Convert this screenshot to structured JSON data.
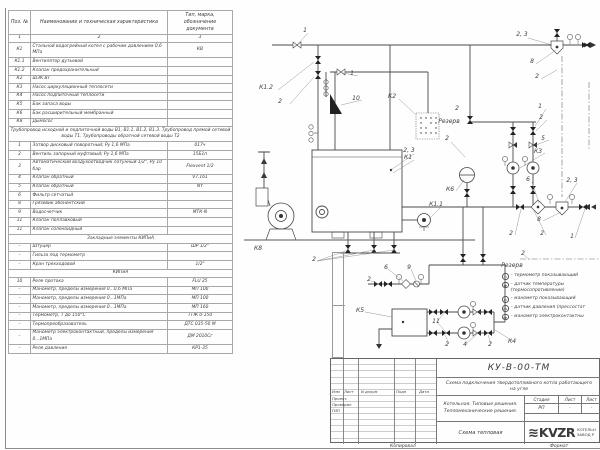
{
  "table": {
    "headers": {
      "pos": "Поз. №",
      "name": "Наименование и техническая характеристика",
      "type": "Тип, марка, обозначение документа"
    },
    "column_numbers": [
      "1",
      "2",
      "3"
    ],
    "rows": [
      {
        "p": "К1",
        "n": "Стальной водогрейный котел с рабочим давлением 0,6 МПа",
        "t": "КВ"
      },
      {
        "p": "К1.1",
        "n": "Вентилятор дутьевой",
        "t": ""
      },
      {
        "p": "К1.2",
        "n": "Клапан предохранительный",
        "t": ""
      },
      {
        "p": "К2",
        "n": "ШЗК ВТ",
        "t": ""
      },
      {
        "p": "К3",
        "n": "Насос циркуляционный теплосети",
        "t": ""
      },
      {
        "p": "К4",
        "n": "Насос подпиточный теплосети",
        "t": ""
      },
      {
        "p": "К5",
        "n": "Бак запаса воды",
        "t": ""
      },
      {
        "p": "К6",
        "n": "Бак расширительный мембранный",
        "t": ""
      },
      {
        "p": "К8",
        "n": "Дымосос",
        "t": ""
      },
      {
        "s": "Трубопровод исходной и подпиточной воды В1, В1.1, В1.2, В1.3. Трубопровод прямой сетевой воды Т1. Трубопроводы обратной сетевой воды Т2"
      },
      {
        "p": "1",
        "n": "Затвор дисковый поворотный; Ру 1,6 МПа",
        "t": "017ч"
      },
      {
        "p": "2",
        "n": "Вентиль запорный муфтовый; Ру 1,6 МПа",
        "t": "15Б1п"
      },
      {
        "p": "3",
        "n": "Автоматический воздухоотводчик латунный 1/2\", Ру 10 бар",
        "t": "Flexvent 1/2"
      },
      {
        "p": "4",
        "n": "Клапан обратный",
        "t": "V7.161"
      },
      {
        "p": "5",
        "n": "Клапан обратный",
        "t": "NY"
      },
      {
        "p": "6",
        "n": "Фильтр сетчатый",
        "t": ""
      },
      {
        "p": "8",
        "n": "Грязевик абонентский",
        "t": ""
      },
      {
        "p": "9",
        "n": "Водосчетчик",
        "t": "МТК-N"
      },
      {
        "p": "11",
        "n": "Клапан поплавковый",
        "t": ""
      },
      {
        "p": "11",
        "n": "Клапан соленоидный",
        "t": ""
      },
      {
        "s": "Закладные элементы КИПиА"
      },
      {
        "p": "–",
        "n": "Штуцер",
        "t": "ШР 1/2\""
      },
      {
        "p": "–",
        "n": "Гильза под термометр",
        "t": ""
      },
      {
        "p": "–",
        "n": "Кран трехходовой",
        "t": "1/2\""
      },
      {
        "s": "КИПиА"
      },
      {
        "p": "10",
        "n": "Реле протока",
        "t": "FLU 25"
      },
      {
        "p": "–",
        "n": "Манометр, пределы измерения 0...0,6 МПа",
        "t": "МП 100"
      },
      {
        "p": "–",
        "n": "Манометр, пределы измерения 0...1МПа",
        "t": "МП 100"
      },
      {
        "p": "–",
        "n": "Манометр, пределы измерения 0...1МПа",
        "t": "МП 160"
      },
      {
        "p": "–",
        "n": "Термометр, Т до 150°С",
        "t": "ТТЖ 0-150"
      },
      {
        "p": "–",
        "n": "Термопреобразователь",
        "t": "ДТС 035-50 М"
      },
      {
        "p": "–",
        "n": "Манометр электроконтактный, пределы измерения 0...1МПа",
        "t": "ДМ 2010Сг"
      },
      {
        "p": "–",
        "n": "Реле давления",
        "t": "КР1-35"
      }
    ]
  },
  "schematic": {
    "labels": [
      {
        "t": "1",
        "x": 305,
        "y": 31
      },
      {
        "t": "К1.2",
        "x": 266,
        "y": 88
      },
      {
        "t": "2",
        "x": 280,
        "y": 102
      },
      {
        "t": "1",
        "x": 352,
        "y": 74
      },
      {
        "t": "10",
        "x": 356,
        "y": 99
      },
      {
        "t": "К2",
        "x": 392,
        "y": 97
      },
      {
        "t": "Резерв",
        "x": 449,
        "y": 122
      },
      {
        "t": "2",
        "x": 457,
        "y": 109
      },
      {
        "t": "2, 3",
        "x": 409,
        "y": 151
      },
      {
        "t": "К1",
        "x": 408,
        "y": 158
      },
      {
        "t": "К8",
        "x": 258,
        "y": 249
      },
      {
        "t": "К1.1",
        "x": 436,
        "y": 205
      },
      {
        "t": "К6",
        "x": 450,
        "y": 190
      },
      {
        "t": "2",
        "x": 447,
        "y": 139
      },
      {
        "t": "2, 3",
        "x": 522,
        "y": 35
      },
      {
        "t": "8",
        "x": 532,
        "y": 62
      },
      {
        "t": "2",
        "x": 537,
        "y": 77
      },
      {
        "t": "1",
        "x": 540,
        "y": 107
      },
      {
        "t": "2",
        "x": 541,
        "y": 118
      },
      {
        "t": "5",
        "x": 543,
        "y": 139
      },
      {
        "t": "К3",
        "x": 538,
        "y": 152
      },
      {
        "t": "6",
        "x": 528,
        "y": 180
      },
      {
        "t": "2, 3",
        "x": 572,
        "y": 181
      },
      {
        "t": "8",
        "x": 539,
        "y": 220
      },
      {
        "t": "2",
        "x": 511,
        "y": 234
      },
      {
        "t": "2",
        "x": 542,
        "y": 234
      },
      {
        "t": "1",
        "x": 572,
        "y": 237
      },
      {
        "t": "2",
        "x": 314,
        "y": 260
      },
      {
        "t": "2",
        "x": 369,
        "y": 280
      },
      {
        "t": "6",
        "x": 386,
        "y": 268
      },
      {
        "t": "9",
        "x": 409,
        "y": 268
      },
      {
        "t": "2",
        "x": 523,
        "y": 254
      },
      {
        "t": "К5",
        "x": 360,
        "y": 311
      },
      {
        "t": "11",
        "x": 436,
        "y": 322
      },
      {
        "t": "2",
        "x": 447,
        "y": 345
      },
      {
        "t": "4",
        "x": 465,
        "y": 345
      },
      {
        "t": "2",
        "x": 490,
        "y": 345
      },
      {
        "t": "К4",
        "x": 512,
        "y": 342
      },
      {
        "t": "Резерв",
        "x": 512,
        "y": 266
      }
    ],
    "legend": {
      "items": [
        {
          "sym": "TI",
          "text": "– термометр показывающий"
        },
        {
          "sym": "TE",
          "text": "– датчик температуры\n(термосопротивление)"
        },
        {
          "sym": "PI",
          "text": "– манометр показывающий"
        },
        {
          "sym": "PS",
          "text": "– датчик давления (прессостат"
        },
        {
          "sym": "PE",
          "text": "– манометр электроконтактны"
        }
      ]
    }
  },
  "title_block": {
    "doc_number": "КУ-В-00-ТМ",
    "subject": "Схема подключения твердотопливного котла работающего на угле",
    "object_line1": "Котельная. Типовые решения.",
    "object_line2": "Тепломеханические решения.",
    "sheet_name": "Схема тепловая",
    "stage_label": "Стадия",
    "sheet_label": "Лист",
    "sheets_label": "Лист",
    "stage": "РП",
    "sheet": "-",
    "sheets": "-",
    "sig_cols": [
      "Изм",
      "Лист",
      "N докум",
      "Подп",
      "Дата"
    ],
    "sig_rows": [
      "Проект.",
      "Проверил",
      "ГИП"
    ],
    "logo_text": "KVZR",
    "logo_line1": "КОТЕЛЬН",
    "logo_line2": "ЗАВОД Р",
    "footer_left": "Копировал",
    "footer_right": "Формат"
  }
}
